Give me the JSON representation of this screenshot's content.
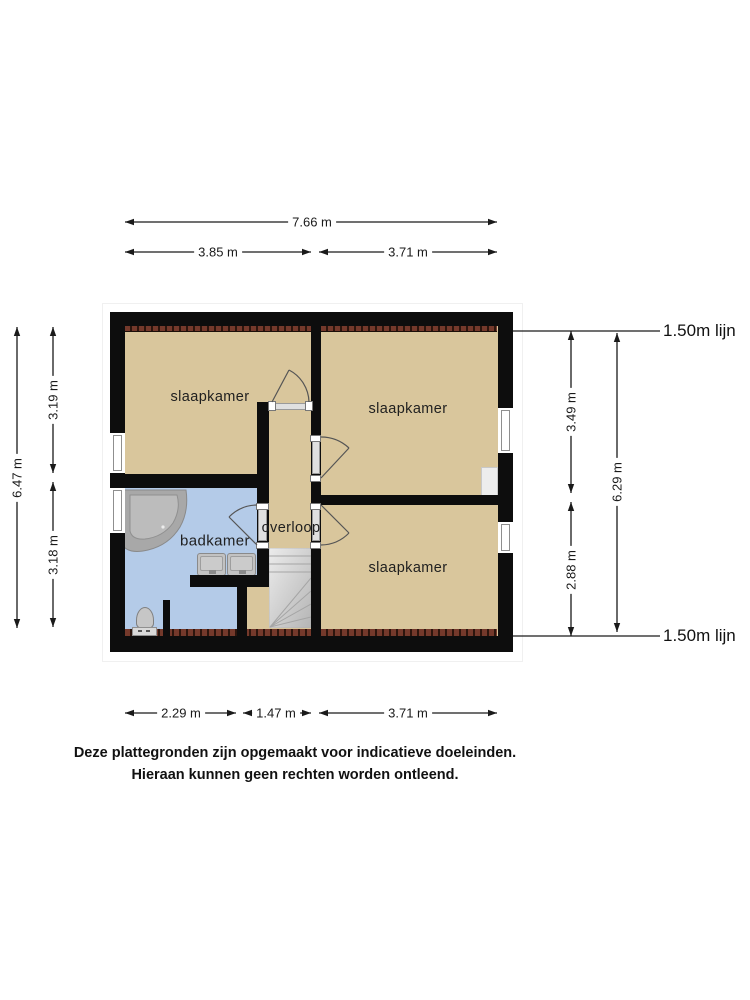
{
  "rooms": {
    "bedroom_top_left": "slaapkamer",
    "bedroom_top_right": "slaapkamer",
    "bedroom_bottom_right": "slaapkamer",
    "bathroom": "badkamer",
    "landing": "overloop"
  },
  "dimensions": {
    "width_total": "7.66 m",
    "width_left": "3.85 m",
    "width_right": "3.71 m",
    "bottom_left": "2.29 m",
    "bottom_middle": "1.47 m",
    "bottom_right": "3.71 m",
    "height_total_left": "6.47 m",
    "height_left_top": "3.19 m",
    "height_left_bottom": "3.18 m",
    "height_right_top": "3.49 m",
    "height_right_bottom": "2.88 m",
    "height_total_right": "6.29 m",
    "attic_line_top": "1.50m lijn",
    "attic_line_bottom": "1.50m lijn"
  },
  "footer": {
    "line1": "Deze plattegronden zijn opgemaakt voor indicatieve doeleinden.",
    "line2": "Hieraan kunnen geen rechten worden ontleend."
  },
  "colors": {
    "room_fill": "#d9c69c",
    "bathroom_fill": "#b4cbe8",
    "wall": "#0d0d0d",
    "brick": "#74392b",
    "fixture_gray": "#c2c2c2",
    "dimension_text": "#1a1a1a"
  }
}
